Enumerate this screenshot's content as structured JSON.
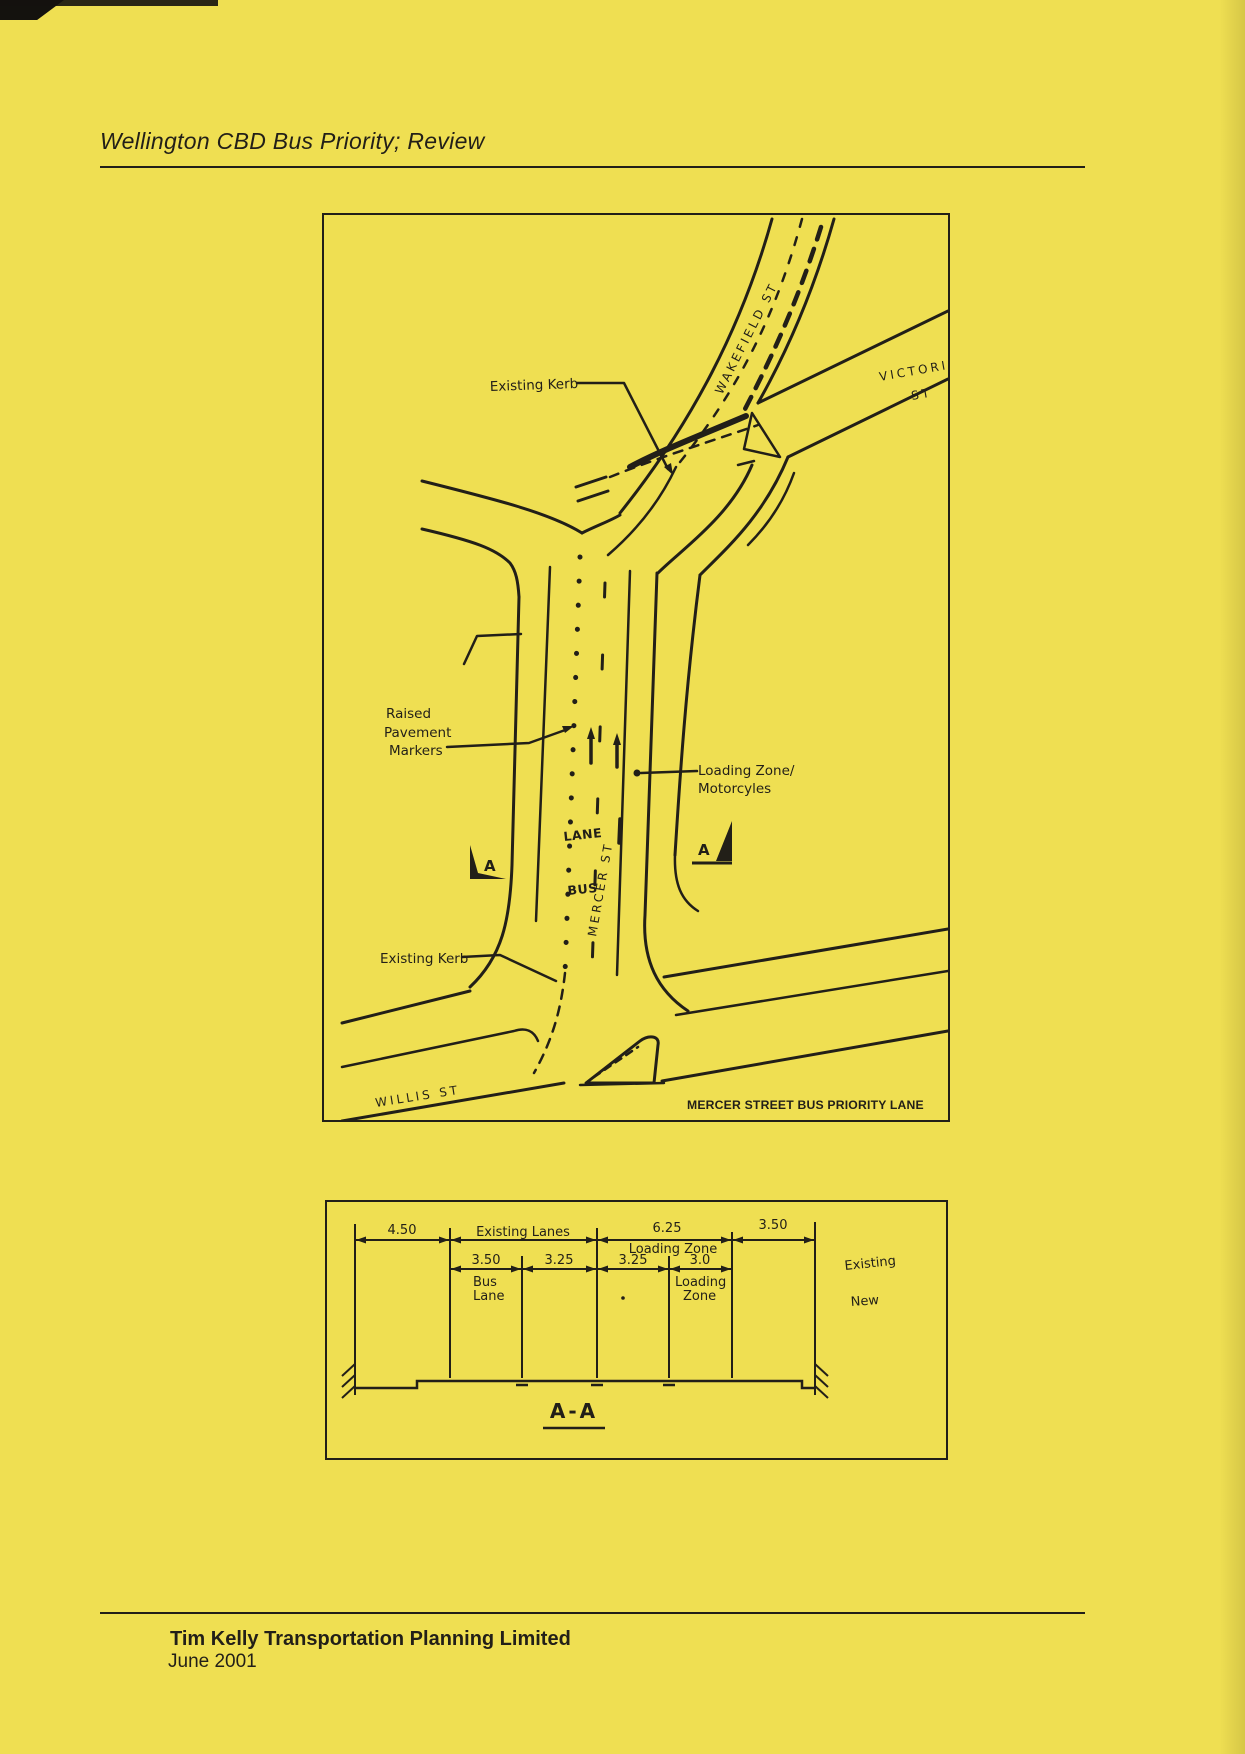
{
  "colors": {
    "paper": "#efdf52",
    "ink": "#221f18"
  },
  "header": {
    "title": "Wellington CBD Bus Priority; Review"
  },
  "map": {
    "caption": "MERCER STREET BUS PRIORITY LANE",
    "labels": {
      "existing_kerb_top": "Existing Kerb",
      "existing_kerb_bottom": "Existing Kerb",
      "rpm_line1": "Raised",
      "rpm_line2": "Pavement",
      "rpm_line3": "Markers",
      "loading_line1": "Loading Zone/",
      "loading_line2": "Motorcyles",
      "wakefield": "WAKEFIELD  ST",
      "victoria_line1": "VICTORIA",
      "victoria_line2": "ST",
      "mercer": "MERCER  ST",
      "willis": "WILLIS  ST",
      "road_marking_lane": "LANE",
      "road_marking_bus": "BUS",
      "section_marker_left": "A",
      "section_marker_right": "A"
    }
  },
  "section": {
    "label": "A-A",
    "existing_label": "Existing",
    "new_label": "New",
    "top_dims": [
      {
        "value": "4.50"
      },
      {
        "value": "Existing Lanes"
      },
      {
        "value": "6.25",
        "sub": "Loading Zone"
      },
      {
        "value": "3.50"
      }
    ],
    "new_dims": [
      {
        "value": "3.50",
        "sub1": "Bus",
        "sub2": "Lane"
      },
      {
        "value": "3.25"
      },
      {
        "value": "3.25"
      },
      {
        "value": "3.0",
        "sub1": "Loading",
        "sub2": "Zone"
      }
    ]
  },
  "footer": {
    "company": "Tim Kelly Transportation Planning Limited",
    "date": "June 2001"
  }
}
